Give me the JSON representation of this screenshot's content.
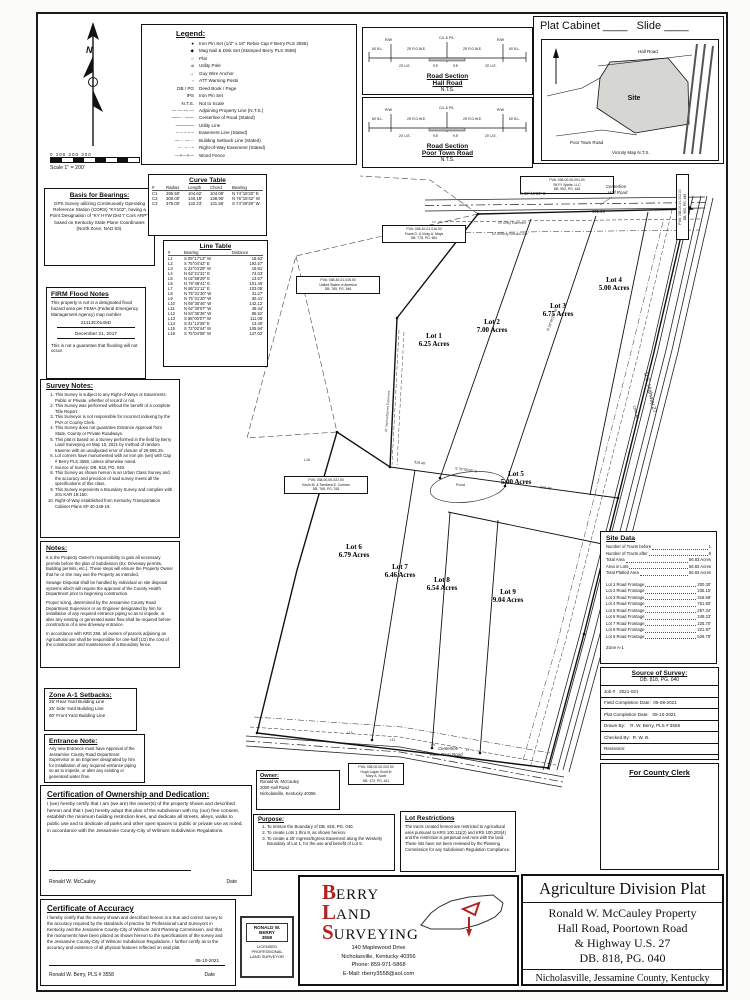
{
  "header": {
    "plat_cabinet_label": "Plat Cabinet",
    "cabinet_blank": "____",
    "slide_label": "Slide",
    "slide_blank": "____"
  },
  "scale": {
    "ticks": "0    100   200   300",
    "caption": "Scale 1\" = 200'"
  },
  "legend": {
    "title": "Legend:",
    "items": [
      {
        "sym": "●",
        "label": "Iron Pin Set (1/2\" x 18\" Rebar Cap # Berry PLS 3558)"
      },
      {
        "sym": "◆",
        "label": "Mag Nail & Disk Set (Stamped Berry PLS 3558)"
      },
      {
        "sym": "○",
        "label": "Plat"
      },
      {
        "sym": "⌀",
        "label": "Utility Pole"
      },
      {
        "sym": "→",
        "label": "Guy Wire Anchor"
      },
      {
        "sym": "▫",
        "label": "ATT Warning Posts"
      },
      {
        "sym": "DB / PG",
        "label": "Deed Book / Page"
      },
      {
        "sym": "IPS",
        "label": "Iron Pin Set"
      },
      {
        "sym": "N.T.S.",
        "label": "Not to Scale"
      },
      {
        "sym": "— — — —",
        "label": "Adjoining Property Line (N.T.S.)"
      },
      {
        "sym": "—— · ——",
        "label": "Centerline of Road (Stated)"
      },
      {
        "sym": "————",
        "label": "Utility Line"
      },
      {
        "sym": "– – – – –",
        "label": "Easement Line (Stated)"
      },
      {
        "sym": "— ·· — ··",
        "label": "Building Setback Line (Stated)"
      },
      {
        "sym": "– · – · –",
        "label": "Right-of-Way Easement (Stated)"
      },
      {
        "sym": "—×—×—",
        "label": "Wood Fence"
      }
    ]
  },
  "road_sections": {
    "dims": {
      "rw": "R/W",
      "cl": "C/L & P/L",
      "bl": "60' B.L.",
      "rowe": "25' R.O.W.E.",
      "half": "9.5'",
      "ue": "20' U.E."
    },
    "sections": [
      {
        "line1": "Road Section",
        "line2": "Hall Road",
        "nts": "N.T.S."
      },
      {
        "line1": "Road Section",
        "line2": "Poor Town Road",
        "nts": "N.T.S."
      }
    ]
  },
  "vicinity": {
    "hall": "Hall Road",
    "site": "Site",
    "poortown": "Poor Town Road",
    "caption": "Vicinity Map N.T.S."
  },
  "basis": {
    "title": "Basis for Bearings:",
    "body": "GPS Survey utilizing Continuously Operating Reference Station (CORS) \"KY102\", having a Point Designation of \"KY HYW Dist 7 Cors ARP\", based on Kentucky State Plane Coordinates (North Zone, NAD 83)."
  },
  "curve_table": {
    "title": "Curve Table",
    "headers": [
      "#",
      "Radius",
      "Length",
      "Chord",
      "Bearing"
    ],
    "rows": [
      [
        "C1",
        "295.50'",
        "104.62'",
        "104.08'",
        "N 74°18'20\" E"
      ],
      [
        "C2",
        "300.00'",
        "140.18'",
        "138.90'",
        "N 76°18'42\" W"
      ],
      [
        "C3",
        "375.00'",
        "132.23'",
        "131.55'",
        "S 74°28'39\" W"
      ]
    ]
  },
  "line_table": {
    "title": "Line Table",
    "headers": [
      "#",
      "Bearing",
      "Distance"
    ],
    "rows": [
      [
        "L1",
        "S 09°17'13\" W",
        "18.62'"
      ],
      [
        "L2",
        "S 75°04'42\" E",
        "192.57'"
      ],
      [
        "L3",
        "S 22°04'29\" W",
        "19.81'"
      ],
      [
        "L4",
        "N 62°21'31\" E",
        "74.03'"
      ],
      [
        "L5",
        "N 02°58'29\" E",
        "13.57'"
      ],
      [
        "L6",
        "N 79°48'41\" E",
        "101.45'"
      ],
      [
        "L7",
        "N 86°21'11\" E",
        "103.05'"
      ],
      [
        "L8",
        "N 75°31'30\" W",
        "31.27'"
      ],
      [
        "L9",
        "N 75°31'30\" W",
        "30.41'"
      ],
      [
        "L10",
        "N 69°35'46\" W",
        "142.12'"
      ],
      [
        "L11",
        "N 62°30'07\" W",
        "49.44'"
      ],
      [
        "L12",
        "N 84°36'36\" W",
        "85.52'"
      ],
      [
        "L13",
        "S 88°00'07\" W",
        "111.06'"
      ],
      [
        "L14",
        "S 31°13'36\" E",
        "13.40'"
      ],
      [
        "L15",
        "S 72°02'44\" W",
        "105.94'"
      ],
      [
        "L16",
        "S 75°04'08\" W",
        "147.02'"
      ]
    ]
  },
  "firm": {
    "title": "FIRM Flood Notes",
    "body": "This property is not in a designated flood hazard area per FEMA (Federal Emergency Management Agency) map number",
    "map_number": "21113C0145D",
    "date": "December 21, 2017",
    "footer": "This is not a guarantee that flooding will not occur."
  },
  "survey_notes": {
    "title": "Survey Notes:",
    "items": [
      "This Survey is subject to any Right-of-Ways or Easements Public or Private, whether of record or not.",
      "This Survey was performed without the benefit of a complete Title Report.",
      "This Surveyor is not responsible for incorrect indexing by the PVA or County Clerk.",
      "This Survey does not guarantee Entrance Approval from State, County or Private Roadways.",
      "This plat is based on a Survey performed in the field by Berry Land Surveying on May 10, 2021 by method of random traverse with an unadjusted error of closure of 29,565.25.",
      "Lot corners have monumented with an iron pin (set) with Cap # Berry PLS 3558, unless otherwise noted.",
      "Source of Survey: DB. 818, PG. 040.",
      "This Survey as shown hereon is an Urban Class Survey and the accuracy and precision of said survey meets all the specifications of this class.",
      "This Survey represents a Boundary Survey and complies with 201 KAR 18:150.",
      "Right-of-Way established from Kentucky Transportation Cabinet Plans SP 40-148-19."
    ]
  },
  "notes": {
    "title": "Notes:",
    "paragraphs": [
      "It is the Property Owner's responsibility to gain all necessary permits before the plan of Subdivision (Ex: Driveway permits, Building permits, etc.). These steps will ensure the Property Owner that he or she may use the Property as intended.",
      "Sewage Disposal shall be handled by individual on site disposal systems which will require the approval of the County Health Department prior to beginning construction.",
      "Proper sizing, determined by the Jessamine County Road Department Supervisor or an Engineer designated by him for installation of any required entrance piping so as to impede, or alter any existing or generated water flow shall be required before construction of a new driveway entrance.",
      "In accordance with KRS 256, all owners of parcels adjoining an Agricultural use shall be responsible for one-half (1/2) the cost of the construction and maintenance of a Boundary fence."
    ]
  },
  "setbacks": {
    "title": "Zone A-1 Setbacks:",
    "items": [
      "25' Rear Yard Building Line",
      "25' Side Yard Building Line",
      "60' Front Yard Building Line"
    ]
  },
  "entrance": {
    "title": "Entrance Note:",
    "body": "Any new Entrance must have Approval of the Jessamine County Road Department Supervisor or an Engineer designated by him for installation of any required entrance piping so as to impede, or alter any existing or generated water flow."
  },
  "ownership": {
    "title": "Certification of Ownership and Dedication:",
    "body": "I (we) hereby certify that I am (we are) the owner(s) of the property shown and described hereon and that I (we) hereby adopt this plan of the subdivision with my (our) free consent, establish the minimum building restriction lines, and dedicate all streets, alleys, walks to public use and to dedicate all parks and other open spaces to public or private use as noted, in accordance with the Jessamine County-City of Wilmore Subdivision Regulations.",
    "signer": "Ronald W. McCauley",
    "date_label": "Date"
  },
  "accuracy": {
    "title": "Certificate of Accuracy",
    "body": "I hereby certify that the survey shown and described hereon is a true and correct survey to the accuracy required by the standards of practice for Professional Land Surveyors in Kentucky and the Jessamine County-City of Wilmore Joint Planning Commission, and that the monuments have been placed as shown hereon to the specifications of the survey and the Jessamine County-City of Wilmore Subdivision Regulations. I further certify as to the accuracy and existence of all physical features reflected on said plat.",
    "date": "05-10-2021",
    "signer": "Ronald W. Berry, PLS # 3558",
    "date_label": "Date"
  },
  "stamp": {
    "name1": "RONALD W.",
    "name2": "BERRY",
    "number": "3558",
    "l1": "LICENSED",
    "l2": "PROFESSIONAL",
    "l3": "LAND SURVEYOR"
  },
  "owner": {
    "title": "Owner:",
    "lines": [
      "Ronald W. McCauley",
      "2000 Hall Road",
      "Nicholasville, Kentucky 40356"
    ]
  },
  "purpose": {
    "title": "Purpose:",
    "items": [
      "To retrace the Boundary of DB. 818, PG. 040.",
      "To create Lots 1 thru 9, as shown hereon.",
      "To create a 25' Ingress/Egress Easement along the Westerly Boundary of Lot 1, for the use and benefit of Lot 5."
    ]
  },
  "lot_restrictions": {
    "title": "Lot Restrictions",
    "body": "The tracts created hereon are restricted to Agricultural uses pursuant to KRS 100.111(2) and KRS 100.203(4) and the restriction is perpetual and runs with the land. These lots have not been reviewed by the Planning Commission for any Subdivision Regulation Compliance."
  },
  "site_data": {
    "title": "Site Data",
    "rows": [
      {
        "label": "Number of Tracts before",
        "value": "1"
      },
      {
        "label": "Number of Tracts after",
        "value": "9"
      },
      {
        "label": "Total Area",
        "value": "56.83 Acres"
      },
      {
        "label": "Area in Lots",
        "value": "56.83 Acres"
      },
      {
        "label": "Total Platted Area",
        "value": "56.83 Acres"
      }
    ],
    "frontage": [
      {
        "label": "Lot 1 Road Frontage",
        "value": "200.30'"
      },
      {
        "label": "Lot 2 Road Frontage",
        "value": "235.15'"
      },
      {
        "label": "Lot 3 Road Frontage",
        "value": "318.58'"
      },
      {
        "label": "Lot 4 Road Frontage",
        "value": "751.80'"
      },
      {
        "label": "Lot 5 Road Frontage",
        "value": "257.34'"
      },
      {
        "label": "Lot 6 Road Frontage",
        "value": "249.23'"
      },
      {
        "label": "Lot 7 Road Frontage",
        "value": "225.70'"
      },
      {
        "label": "Lot 8 Road Frontage",
        "value": "221.97'"
      },
      {
        "label": "Lot 9 Road Frontage",
        "value": "528.79'"
      }
    ],
    "zone": "Zone A-1"
  },
  "source": {
    "title": "Source of Survey:",
    "subtitle": "DB. 818, PG. 040",
    "rows": [
      "Job #   2021-021",
      "Field Completion Date:  05-08-2021",
      "Plat Completion Date:   05-10-2021",
      "Drawn By:    R. W. Berry, PLS # 3558",
      "Checked By:  R. W. B.",
      "Revisions:"
    ]
  },
  "clerk": {
    "title": "For County Clerk"
  },
  "plat": {
    "lots": [
      {
        "name": "Lot 1",
        "acres": "6.25 Acres"
      },
      {
        "name": "Lot 2",
        "acres": "7.00 Acres"
      },
      {
        "name": "Lot 3",
        "acres": "6.75 Acres"
      },
      {
        "name": "Lot 4",
        "acres": "5.00 Acres"
      },
      {
        "name": "Lot 5",
        "acres": "5.00 Acres"
      },
      {
        "name": "Lot 6",
        "acres": "6.79 Acres"
      },
      {
        "name": "Lot 7",
        "acres": "6.46 Acres"
      },
      {
        "name": "Lot 8",
        "acres": "6.54 Acres"
      },
      {
        "name": "Lot 9",
        "acres": "9.04 Acres"
      }
    ],
    "pva_boxes": [
      {
        "lines": [
          "PVA: 038-00-00-001.00",
          "SKYY Spirits, LLC",
          "DB. 992, PG. 445"
        ]
      },
      {
        "lines": [
          "PVA: 038-40-01-016.00",
          "Frank D. & Vicky A. Mays",
          "DB. 778, PG. 681"
        ]
      },
      {
        "lines": [
          "PVA: 038-40-01-015.00",
          "United States of America",
          "DB. 785, PG. 546"
        ]
      },
      {
        "lines": [
          "PVA: 038-00-00-022.00",
          "Kevin M. & Tambera E. Corman",
          "DB. 768, PG. 318"
        ]
      },
      {
        "lines": [
          "PVA: 038-00-00-020.00",
          "Hugh Logan Scott III",
          "Mary A. Scott",
          "DB. 470, PG. 441"
        ]
      },
      {
        "lines": [
          "PVA: 038-00-00-002.00",
          "DB. 992, PG. 445"
        ]
      }
    ],
    "annotations": [
      {
        "t": "S 89°49'09\" E"
      },
      {
        "t": "939.93'"
      },
      {
        "t": "Centerline"
      },
      {
        "t": "Hall Road"
      },
      {
        "t": "Centerline"
      },
      {
        "t": "Poor Town Road"
      },
      {
        "t": "U.S. Highway 27"
      },
      {
        "t": "S 79°05'06\" E"
      },
      {
        "t": "318.40'"
      },
      {
        "t": "218.40'"
      },
      {
        "t": "N 24°46'23\" W"
      },
      {
        "t": "20' Utility Easement"
      },
      {
        "t": "60' Building Setback Line"
      },
      {
        "t": "Pond"
      },
      {
        "t": "25' Ingress/Egress Easement"
      },
      {
        "t": "1294.44'"
      },
      {
        "t": "L16"
      },
      {
        "t": "L13"
      },
      {
        "t": "L11"
      },
      {
        "t": "L9"
      },
      {
        "t": "L7"
      }
    ]
  },
  "berry": {
    "w1a": "B",
    "w1b": "ERRY",
    "w2a": "L",
    "w2b": "AND",
    "w3a": "S",
    "w3b": "URVEYING",
    "address": [
      "140 Maplewood Drive",
      "Nicholasville, Kentucky 40356",
      "Phone: 859-971-5868",
      "E-Mail: rberry3558@aol.com"
    ],
    "accent": "#b22222"
  },
  "title_block": {
    "title": "Agriculture Division Plat",
    "lines": [
      "Ronald W. McCauley Property",
      "Hall Road, Poortown Road",
      "& Highway U.S. 27",
      "DB. 818, PG. 040"
    ],
    "footer": "Nicholasville, Jessamine County, Kentucky"
  }
}
